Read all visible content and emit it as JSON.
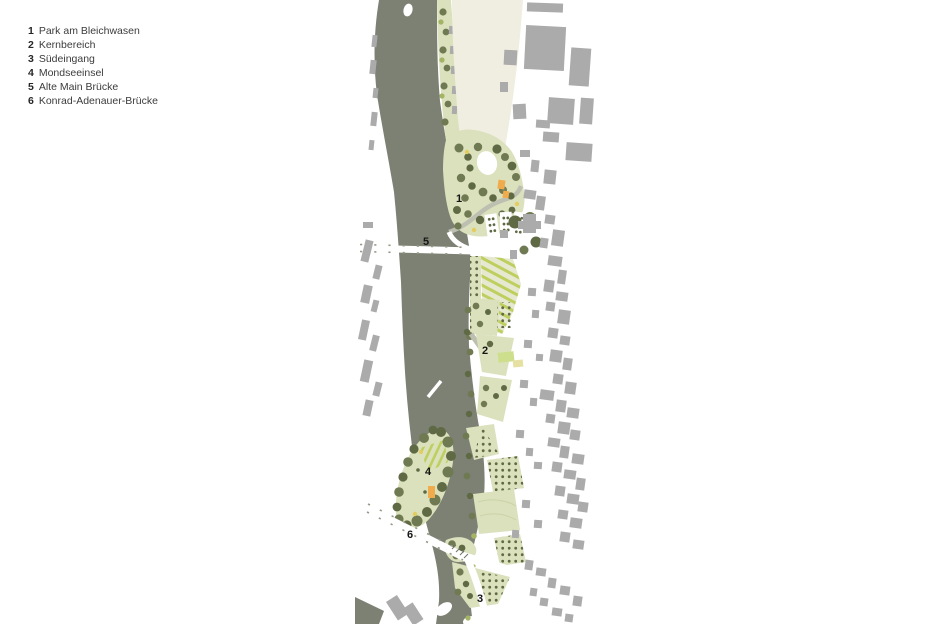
{
  "legend": {
    "items": [
      {
        "number": "1",
        "label": "Park am Bleichwasen"
      },
      {
        "number": "2",
        "label": "Kernbereich"
      },
      {
        "number": "3",
        "label": "Südeingang"
      },
      {
        "number": "4",
        "label": "Mondseeinsel"
      },
      {
        "number": "5",
        "label": "Alte Main Brücke"
      },
      {
        "number": "6",
        "label": "Konrad-Adenauer-Brücke"
      }
    ]
  },
  "map": {
    "markers": [
      {
        "number": "1"
      },
      {
        "number": "2"
      },
      {
        "number": "3"
      },
      {
        "number": "4"
      },
      {
        "number": "5"
      },
      {
        "number": "6"
      }
    ]
  },
  "colors": {
    "river": "#7c8173",
    "park_green": "#dbe1bd",
    "pale_green": "#e6e9d0",
    "stripe_green": "#becf60",
    "tree": "#6f7952",
    "tree_dark": "#5f6a45",
    "tree_light": "#a3b465",
    "building": "#ababab",
    "field_cream": "#f0eee1",
    "accent_orange": "#f0ab4c",
    "accent_yellow": "#e4cd5e",
    "road_gray": "#bdc0b1",
    "tick": "#959b88"
  }
}
